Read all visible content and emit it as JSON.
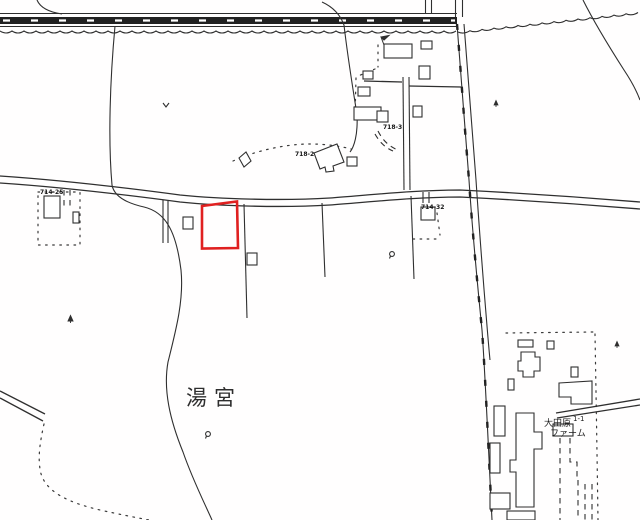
{
  "map": {
    "region_label": "湯宮",
    "parcels": {
      "p718_2": "718-2",
      "p718_3": "718-3",
      "p714_25": "714-25",
      "p714_32": "714-32"
    },
    "farm": {
      "name_line1": "大田原",
      "lot": "1-1",
      "name_line2": "ファーム"
    },
    "colors": {
      "ink": "#2f2f2f",
      "highlight": "#e02020",
      "background": "#ffffff"
    }
  }
}
